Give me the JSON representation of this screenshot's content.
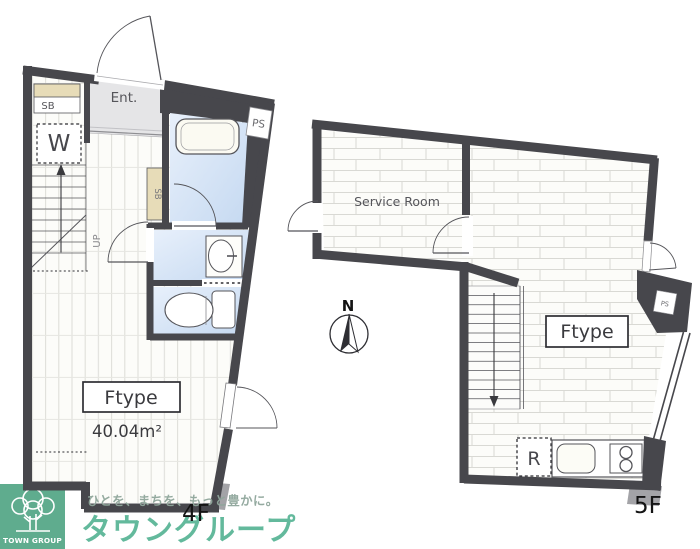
{
  "floor4": {
    "floor_label": "4F",
    "room_type": "Ftype",
    "room_area": "40.04m²",
    "entrance_label": "Ent.",
    "shoebox_label": "SB",
    "shoebox_tall_label": "SB",
    "washer_label": "W",
    "stairs_label": "UP",
    "pipe_space_label": "PS"
  },
  "floor5": {
    "floor_label": "5F",
    "room_type": "Ftype",
    "service_room_label": "Service Room",
    "fridge_label": "R",
    "pipe_space_label": "PS"
  },
  "compass": {
    "north_label": "N"
  },
  "branding": {
    "logo_name": "TOWN GROUP",
    "tagline": "ひとを、まちを、もっと豊かに。",
    "company_name": "タウングループ",
    "brand_green": "#4aa17f",
    "company_text_green": "#5bb697"
  },
  "colors": {
    "wall": "#47474c",
    "wet_room_blue": "#cfdff3",
    "storage_beige": "#e7dcb8",
    "entrance_gray": "#e5e5e7"
  }
}
